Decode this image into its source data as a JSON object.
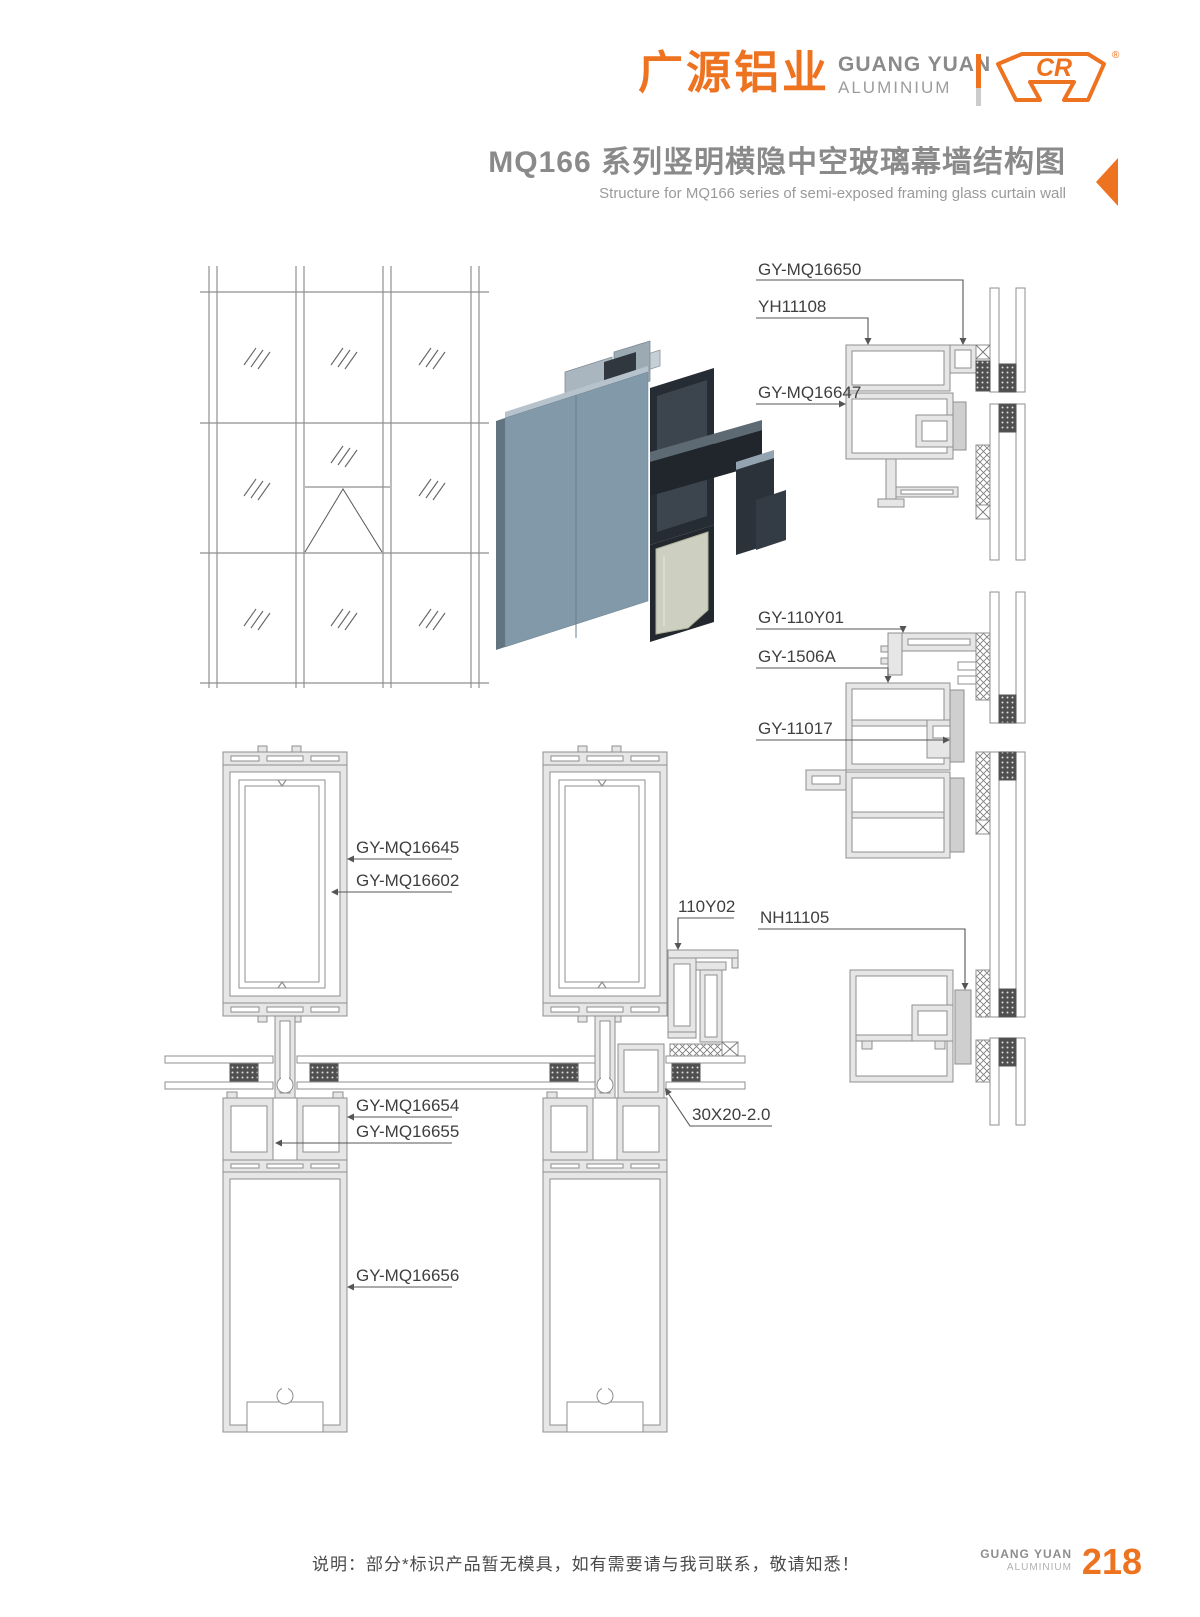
{
  "header": {
    "brand_cn": "广源铝业",
    "brand_en_line1": "GUANG YUAN",
    "brand_en_line2": "ALUMINIUM",
    "logo_mark_text": "CR",
    "registered_mark": "®"
  },
  "title": {
    "cn": "MQ166 系列竖明横隐中空玻璃幕墙结构图",
    "en": "Structure for MQ166 series of semi-exposed framing glass curtain wall"
  },
  "labels": {
    "gy_mq16650": "GY-MQ16650",
    "yh11108": "YH11108",
    "gy_mq16647": "GY-MQ16647",
    "gy_110y01": "GY-110Y01",
    "gy_1506a": "GY-1506A",
    "gy_11017": "GY-11017",
    "nh11105": "NH11105",
    "v_110y02": "110Y02",
    "gy_mq16645": "GY-MQ16645",
    "gy_mq16602": "GY-MQ16602",
    "gy_mq16654": "GY-MQ16654",
    "gy_mq16655": "GY-MQ16655",
    "gy_mq16656": "GY-MQ16656",
    "tube_30x20": "30X20-2.0"
  },
  "footer": {
    "note": "说明：部分*标识产品暂无模具，如有需要请与我司联系，敬请知悉！",
    "brand_en_line1": "GUANG YUAN",
    "brand_en_line2": "ALUMINIUM",
    "page_number": "218"
  },
  "colors": {
    "accent": "#EE7320",
    "title_gray": "#8A8A8A",
    "line_gray": "#8F8F8F"
  }
}
